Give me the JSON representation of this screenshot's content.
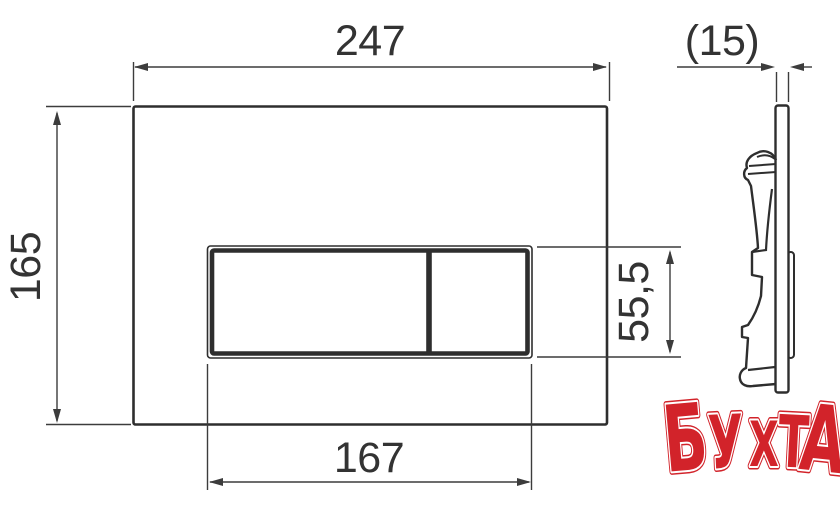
{
  "drawing": {
    "title": "flush-plate-dimension-drawing",
    "dimensions": {
      "plate_width": "247",
      "plate_height": "165",
      "button_width": "167",
      "button_height": "55,5",
      "plate_depth": "(15)"
    }
  },
  "watermark": {
    "text": "БУХТА",
    "letters": [
      "Б",
      "У",
      "Х",
      "Т",
      "А"
    ],
    "color": "#d2232a"
  },
  "colors": {
    "line": "#2e2e2e",
    "dimension_line": "#3c3c3c",
    "background": "#ffffff",
    "watermark_red": "#d2232a"
  }
}
